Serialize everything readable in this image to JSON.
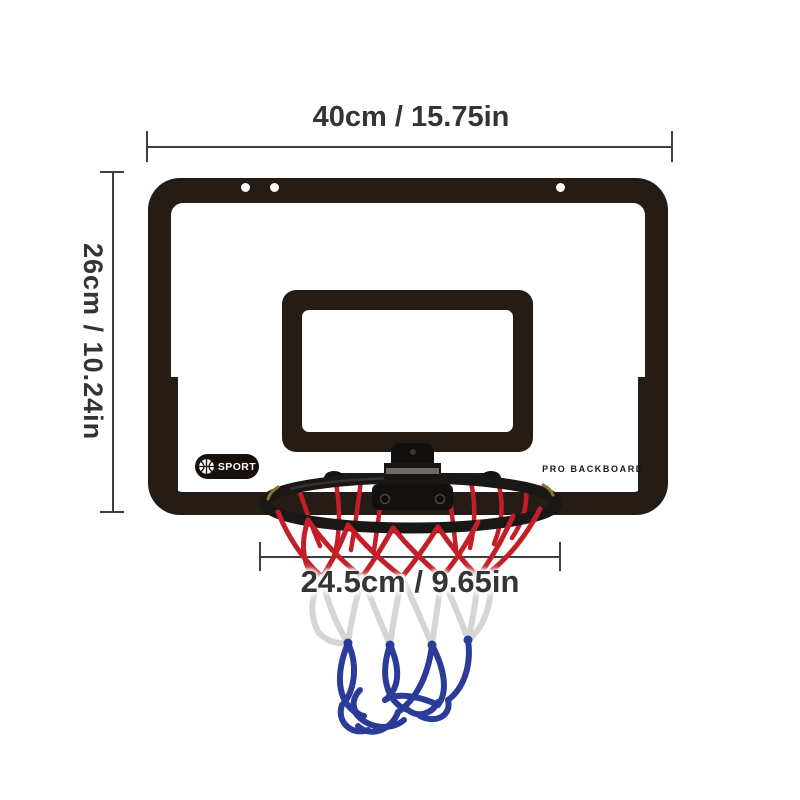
{
  "product_diagram": {
    "width_dimension": {
      "label": "40cm / 15.75in"
    },
    "height_dimension": {
      "label": "26cm / 10.24in"
    },
    "rim_dimension": {
      "label": "24.5cm / 9.65in"
    },
    "backboard": {
      "logo_text": "SPORT",
      "brand_text": "PRO BACKBOARD"
    },
    "colors": {
      "backboard_black": "#261c16",
      "dimension_line": "#3e3e3e",
      "dimension_text": "#343434",
      "net_red": "#c41f28",
      "net_white": "#d5d5d5",
      "net_blue": "#2b3c98",
      "rim_black": "#1a1816",
      "rim_glint": "#8a7431"
    }
  }
}
